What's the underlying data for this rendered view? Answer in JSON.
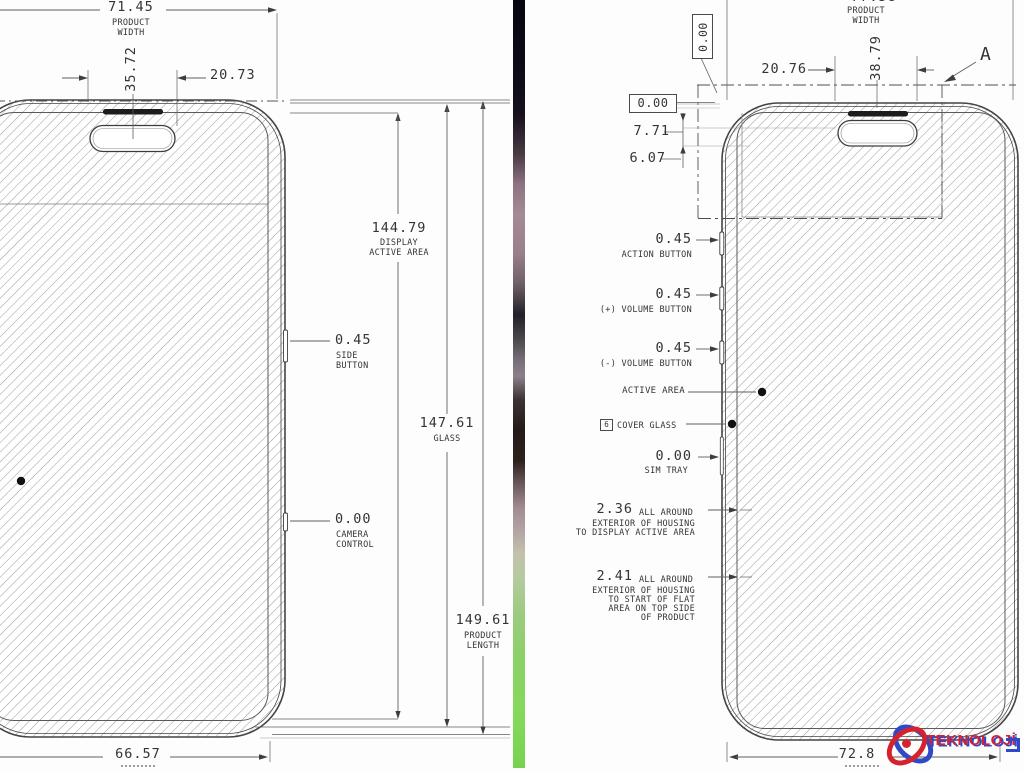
{
  "left": {
    "product_width": {
      "value": "71.45",
      "label1": "PRODUCT",
      "label2": "WIDTH"
    },
    "island_width": "35.72",
    "island_offset": "20.73",
    "display": {
      "value": "144.79",
      "label1": "DISPLAY",
      "label2": "ACTIVE AREA"
    },
    "side_button": {
      "value": "0.45",
      "label1": "SIDE",
      "label2": "BUTTON"
    },
    "glass": {
      "value": "147.61",
      "label": "GLASS"
    },
    "camera_control": {
      "value": "0.00",
      "label1": "CAMERA",
      "label2": "CONTROL"
    },
    "product_length": {
      "value": "149.61",
      "label1": "PRODUCT",
      "label2": "LENGTH"
    },
    "bottom_width": "66.57"
  },
  "right": {
    "product_width": {
      "value": "77.58",
      "label1": "PRODUCT",
      "label2": "WIDTH"
    },
    "datum_zero_top": "0.00",
    "datum_zero_left": "0.00",
    "island_offset": "20.76",
    "island_width": "38.79",
    "detail_label": "A",
    "island_top": "7.71",
    "island_bottom": "6.07",
    "action_button": {
      "value": "0.45",
      "label": "ACTION BUTTON"
    },
    "volume_plus": {
      "value": "0.45",
      "label": "(+) VOLUME BUTTON"
    },
    "volume_minus": {
      "value": "0.45",
      "label": "(-) VOLUME BUTTON"
    },
    "active_area": "ACTIVE AREA",
    "cover_glass": {
      "flag": "6",
      "label": "COVER GLASS"
    },
    "sim_tray": {
      "value": "0.00",
      "label": "SIM TRAY"
    },
    "note_236": {
      "value": "2.36",
      "suffix": "ALL AROUND",
      "line2": "EXTERIOR OF HOUSING",
      "line3": "TO DISPLAY ACTIVE AREA"
    },
    "note_241": {
      "value": "2.41",
      "suffix": "ALL AROUND",
      "line2": "EXTERIOR OF HOUSING",
      "line3": "TO START OF FLAT",
      "line4": "AREA ON TOP SIDE",
      "line5": "OF PRODUCT"
    },
    "bottom_width": "72.8"
  },
  "watermark": {
    "text": "TEKNOLOJİ",
    "logo": "atom-logo",
    "red": "#d5232e",
    "blue": "#2f49c9"
  }
}
